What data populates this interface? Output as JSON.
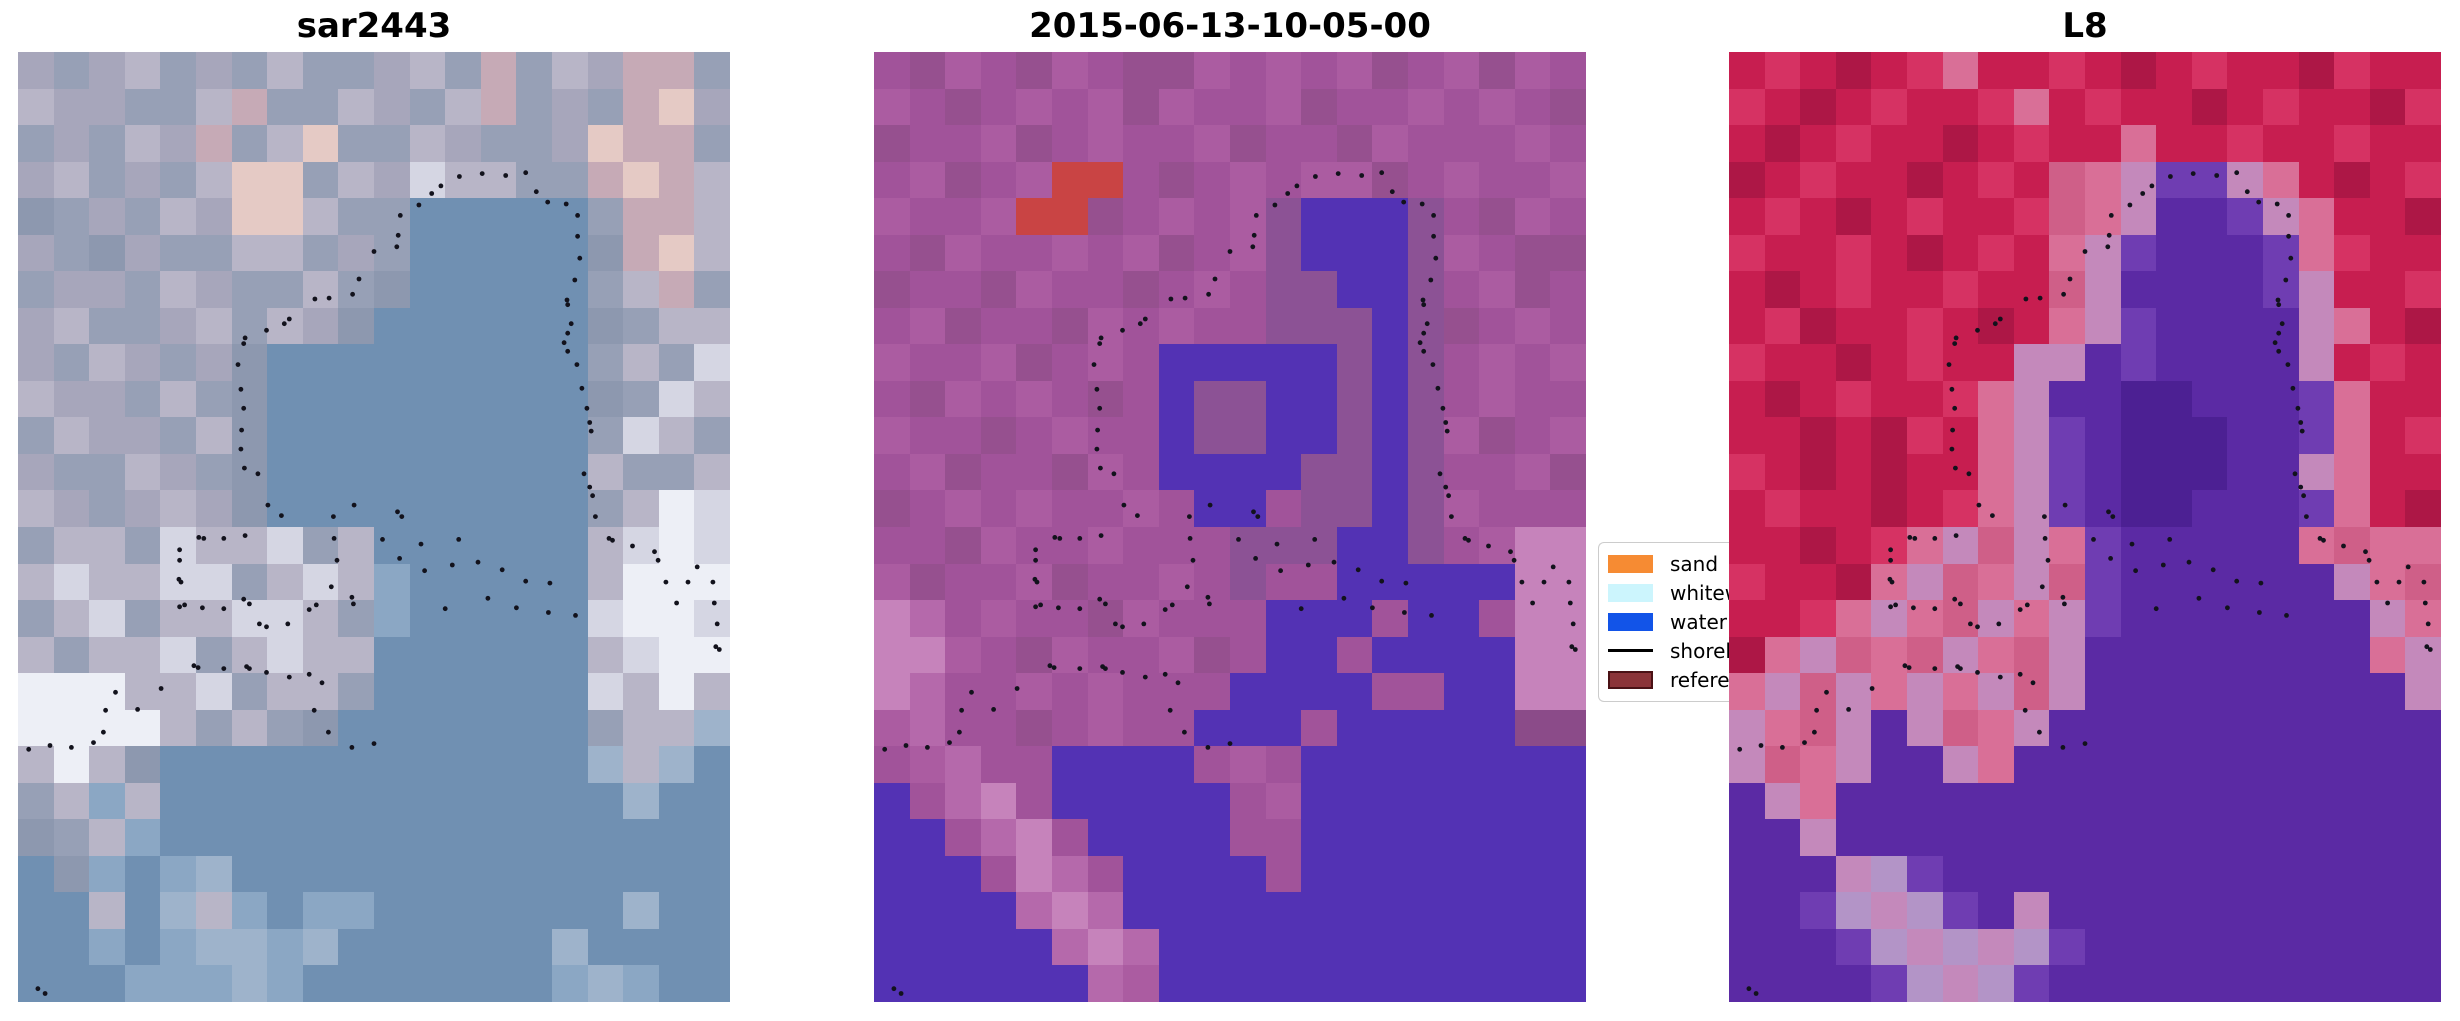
{
  "figure": {
    "width": 2460,
    "height": 1021,
    "background": "#ffffff",
    "dot_color": "#12121c"
  },
  "panels": [
    {
      "title": "sar2443",
      "palette": {
        "a": "#a7a6bb",
        "b": "#97a0b6",
        "c": "#b8b5c7",
        "d": "#c6aab6",
        "e": "#e5cac5",
        "f": "#d5d6e3",
        "g": "#8d98af",
        "h": "#8ba7c4",
        "w": "#7090b2",
        "v": "#9eb3cb",
        "F": "#edeff6"
      },
      "rows": [
        "abacbabcbbacbdbcaddb",
        "caabbcdbbcabcdbabdea",
        "babcadbcebbcabbaeddb",
        "acbabceebcafccbbdedc",
        "gbabcaeecbbwwwwwbddc",
        "abgabbccbabwwwwwgdec",
        "baabcabbcbgwwwwwbcdb",
        "acbbacbcagwwwwwwgbcc",
        "abcabagwwwwwwwwwbcbf",
        "caabcbgwwwwwwwwwgbfc",
        "bcaabcgwwwwwwwwwbfcb",
        "abbcabgwwwwwwwwwcbbc",
        "cabacagwwwwwwwwwbcFf",
        "bccbfccfbcwwwwwwcfFf",
        "cfccffbcfchwwwwwcFFF",
        "bcfbccffcbhwwwwwfFFf",
        "cbccfbcfccwwwwwwcfFF",
        "FFFccfbccbwwwwwwfcFc",
        "FFFFcbcbgwwwwwwwbccv",
        "cFcgwwwwwwwwwwwwvcvw",
        "bchcwwwwwwwwwwwwwvww",
        "gbchwwwwwwwwwwwwwwww",
        "wghwhvwwwwwwwwwwwwww",
        "wwcwvchwhhwwwwwwwvww",
        "wwhwhvvhvwwwwwwvwwww",
        "wwwhhhvhwwwwwwwhvhww"
      ]
    },
    {
      "title": "2015-06-13-10-05-00",
      "palette": {
        "m": "#a1539a",
        "n": "#96508f",
        "o": "#ab5ca1",
        "p": "#8b4b89",
        "q": "#b569ab",
        "Q": "#c683bb",
        "i": "#5332b4",
        "j": "#8c5295",
        "r": "#c94444"
      },
      "rows": [
        "mnomnomnnomomonmonom",
        "omnmomonommonmmomomn",
        "nmmonmommonmmnommmom",
        "monmorrmnmomoonmommo",
        "ommorrnmomojiiijmnom",
        "mnommomonmojiiijomnn",
        "nmmnommnmomjjiijmonm",
        "monmmnomommjjjijnmom",
        "ommonmomiiiiijijmomo",
        "mnomomnmijjiijijmomm",
        "ommnmommijjiijijonmo",
        "monmmnomiiiijjijmmon",
        "nmomommomiimjjijommm",
        "mmnommommmjjjiijmoQQ",
        "onmmonmmomjmmiiiiiQQ",
        "QqmommnommmiiimiimQQ",
        "QQomnommonmiimiiiiQQ",
        "QqmmomommmiiiimmiiQQ",
        "oqmmnmommiiimiiiiipp",
        "moqmmiiiimomiiiiiiii",
        "imqQmiiiiimoiiiiiiii",
        "iimqQmiiiimmiiiiiiii",
        "iiimQqmiiiimiiiiiiii",
        "iiiiqQqiiiiiiiiiiiii",
        "iiiiiqQqiiiiiiiiiiii",
        "iiiiiiqoiiiiiiiiiiii"
      ]
    },
    {
      "title": "L8",
      "palette": {
        "r": "#c71e50",
        "R": "#d63263",
        "k": "#ad1746",
        "x": "#d96f97",
        "y": "#c489bb",
        "z": "#cf5f88",
        "P": "#5b2aa4",
        "p": "#6f3db2",
        "D": "#4c2093",
        "L": "#b394c7"
      },
      "rows": [
        "rRrkrRxrrRrkrRrrkRrr",
        "RrkrRrrRxrRrrkrRrrkR",
        "rkrRrrkrRrrxrrRrrRrr",
        "krRrrkrRrzxyppyxrkrR",
        "rRrkrRrrRzxyPPpyxrrk",
        "RrrRrkrRrxypPPPpxRrr",
        "rkrRrrRrrzyPPPPpyrrR",
        "rRkrrRrkrxypPPPPyxrk",
        "RrrkrRrryyPpPPPPyrRr",
        "rkrRrrRxyPPDDPPPpxrr",
        "rrkrkRrxypPDDDPPpxrR",
        "RrkrkrrxypPDDDPPyxrr",
        "rRrrkrRxypPDDPPPpxrk",
        "rrkrRxyzyxpPPPPPxzxx",
        "RrrkxyzxyzpPPPPPPyxz",
        "rrRxyxzyxypPPPPPPPyx",
        "kxyzxzyxzyPPPPPPPPxy",
        "xyzyxyxyzyPPPPPPPPPy",
        "yxzyPyzxyPPPPPPPPPPP",
        "yzxyPPyxPPPPPPPPPPPP",
        "PyxPPPPPPPPPPPPPPPPP",
        "PPyPPPPPPPPPPPPPPPPP",
        "PPPyLpPPPPPPPPPPPPPP",
        "PPpLyLpPyPPPPPPPPPPP",
        "PPPpLyLyLpPPPPPPPPPP",
        "PPPPpLyLpPPPPPPPPPPP"
      ]
    }
  ],
  "shoreline_dots": [
    [
      0.62,
      0.131
    ],
    [
      0.652,
      0.128
    ],
    [
      0.685,
      0.13
    ],
    [
      0.713,
      0.127
    ],
    [
      0.594,
      0.141
    ],
    [
      0.581,
      0.149
    ],
    [
      0.563,
      0.161
    ],
    [
      0.537,
      0.172
    ],
    [
      0.534,
      0.193
    ],
    [
      0.532,
      0.205
    ],
    [
      0.728,
      0.147
    ],
    [
      0.744,
      0.158
    ],
    [
      0.77,
      0.16
    ],
    [
      0.786,
      0.172
    ],
    [
      0.786,
      0.194
    ],
    [
      0.789,
      0.217
    ],
    [
      0.782,
      0.24
    ],
    [
      0.771,
      0.261
    ],
    [
      0.772,
      0.266
    ],
    [
      0.777,
      0.286
    ],
    [
      0.772,
      0.296
    ],
    [
      0.767,
      0.306
    ],
    [
      0.772,
      0.315
    ],
    [
      0.785,
      0.329
    ],
    [
      0.792,
      0.354
    ],
    [
      0.799,
      0.375
    ],
    [
      0.803,
      0.39
    ],
    [
      0.805,
      0.399
    ],
    [
      0.795,
      0.444
    ],
    [
      0.803,
      0.458
    ],
    [
      0.807,
      0.467
    ],
    [
      0.811,
      0.489
    ],
    [
      0.5,
      0.21
    ],
    [
      0.479,
      0.239
    ],
    [
      0.47,
      0.255
    ],
    [
      0.437,
      0.259
    ],
    [
      0.417,
      0.26
    ],
    [
      0.381,
      0.281
    ],
    [
      0.374,
      0.286
    ],
    [
      0.349,
      0.293
    ],
    [
      0.319,
      0.301
    ],
    [
      0.317,
      0.307
    ],
    [
      0.309,
      0.329
    ],
    [
      0.313,
      0.355
    ],
    [
      0.317,
      0.375
    ],
    [
      0.314,
      0.398
    ],
    [
      0.313,
      0.418
    ],
    [
      0.318,
      0.438
    ],
    [
      0.337,
      0.444
    ],
    [
      0.351,
      0.477
    ],
    [
      0.37,
      0.488
    ],
    [
      0.443,
      0.489
    ],
    [
      0.472,
      0.477
    ],
    [
      0.533,
      0.484
    ],
    [
      0.539,
      0.489
    ],
    [
      0.83,
      0.512
    ],
    [
      0.835,
      0.514
    ],
    [
      0.863,
      0.52
    ],
    [
      0.894,
      0.526
    ],
    [
      0.899,
      0.535
    ],
    [
      0.954,
      0.542
    ],
    [
      0.91,
      0.558
    ],
    [
      0.941,
      0.558
    ],
    [
      0.976,
      0.558
    ],
    [
      0.925,
      0.58
    ],
    [
      0.978,
      0.58
    ],
    [
      0.982,
      0.602
    ],
    [
      0.98,
      0.626
    ],
    [
      0.985,
      0.629
    ],
    [
      0.254,
      0.511
    ],
    [
      0.261,
      0.512
    ],
    [
      0.289,
      0.512
    ],
    [
      0.319,
      0.509
    ],
    [
      0.444,
      0.512
    ],
    [
      0.227,
      0.524
    ],
    [
      0.227,
      0.535
    ],
    [
      0.448,
      0.535
    ],
    [
      0.226,
      0.555
    ],
    [
      0.229,
      0.558
    ],
    [
      0.44,
      0.563
    ],
    [
      0.469,
      0.574
    ],
    [
      0.471,
      0.581
    ],
    [
      0.317,
      0.576
    ],
    [
      0.325,
      0.581
    ],
    [
      0.234,
      0.582
    ],
    [
      0.227,
      0.584
    ],
    [
      0.259,
      0.585
    ],
    [
      0.289,
      0.586
    ],
    [
      0.409,
      0.587
    ],
    [
      0.419,
      0.582
    ],
    [
      0.339,
      0.602
    ],
    [
      0.349,
      0.605
    ],
    [
      0.379,
      0.602
    ],
    [
      0.512,
      0.513
    ],
    [
      0.566,
      0.518
    ],
    [
      0.619,
      0.513
    ],
    [
      0.536,
      0.533
    ],
    [
      0.571,
      0.546
    ],
    [
      0.61,
      0.54
    ],
    [
      0.646,
      0.537
    ],
    [
      0.68,
      0.545
    ],
    [
      0.713,
      0.557
    ],
    [
      0.747,
      0.559
    ],
    [
      0.66,
      0.575
    ],
    [
      0.7,
      0.585
    ],
    [
      0.745,
      0.59
    ],
    [
      0.783,
      0.593
    ],
    [
      0.6,
      0.586
    ],
    [
      0.247,
      0.646
    ],
    [
      0.253,
      0.648
    ],
    [
      0.289,
      0.649
    ],
    [
      0.321,
      0.647
    ],
    [
      0.325,
      0.649
    ],
    [
      0.349,
      0.653
    ],
    [
      0.381,
      0.658
    ],
    [
      0.409,
      0.655
    ],
    [
      0.427,
      0.664
    ],
    [
      0.201,
      0.67
    ],
    [
      0.137,
      0.674
    ],
    [
      0.168,
      0.692
    ],
    [
      0.123,
      0.693
    ],
    [
      0.12,
      0.716
    ],
    [
      0.106,
      0.727
    ],
    [
      0.075,
      0.732
    ],
    [
      0.045,
      0.73
    ],
    [
      0.015,
      0.734
    ],
    [
      0.416,
      0.693
    ],
    [
      0.436,
      0.716
    ],
    [
      0.469,
      0.732
    ],
    [
      0.5,
      0.728
    ],
    [
      0.028,
      0.986
    ],
    [
      0.038,
      0.991
    ]
  ],
  "legend": {
    "items": [
      {
        "label": "sand",
        "type": "patch",
        "color": "#f68b33",
        "border": "#f68b33"
      },
      {
        "label": "whitew",
        "type": "patch",
        "color": "#ccf5fd",
        "border": "#ccf5fd"
      },
      {
        "label": "water",
        "type": "patch",
        "color": "#1254e8",
        "border": "#1254e8"
      },
      {
        "label": "shoreli",
        "type": "line",
        "color": "#000000",
        "border": "#000000"
      },
      {
        "label": "referen",
        "type": "patch",
        "color": "#8b3338",
        "border": "#4a1115"
      }
    ]
  },
  "chart_data": [
    {
      "type": "heatmap",
      "title": "sar2443",
      "note": "SAR RGB composite; pixel colors given as 20x26 downsampled grid in panels[0].rows/palette; dotted overlay = shoreline points (shoreline_dots, fractional coords)"
    },
    {
      "type": "heatmap",
      "title": "2015-06-13-10-05-00",
      "note": "classified optical scene; magenta=land, indigo=water class, red blob=reference patch; grid in panels[1]"
    },
    {
      "type": "heatmap",
      "title": "L8",
      "note": "Landsat-8 false colour; red=land, purple=water; grid in panels[2]"
    },
    {
      "type": "table",
      "title": "legend",
      "categories": [
        "sand",
        "whitew",
        "water",
        "shoreli",
        "referen"
      ],
      "values": [
        "#f68b33",
        "#ccf5fd",
        "#1254e8",
        "#000000",
        "#8b3338"
      ]
    }
  ]
}
